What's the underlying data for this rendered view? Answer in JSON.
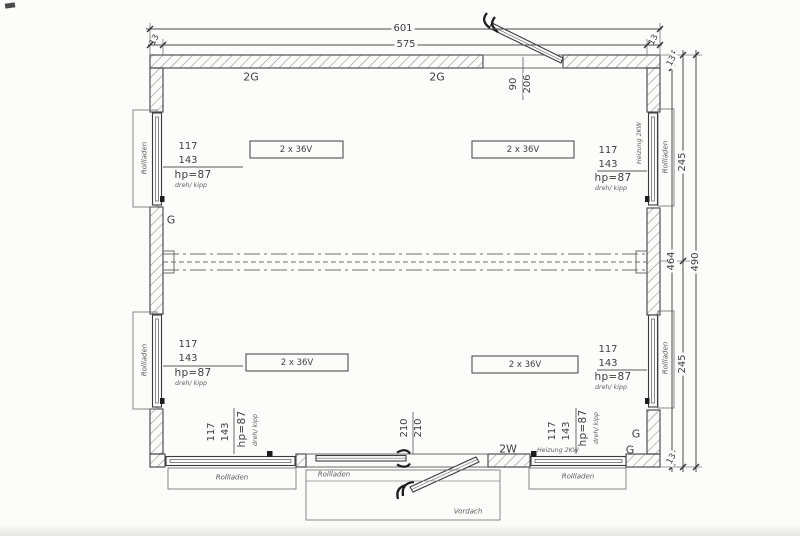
{
  "dimensions": {
    "total_width": "601",
    "inner_width": "575",
    "wall_left": "13",
    "wall_right": "13",
    "wall_top": "13",
    "wall_bottom": "13",
    "inner_height": "464",
    "total_height": "490",
    "half_height_top": "245",
    "half_height_bottom": "245"
  },
  "top_door": {
    "width": "90",
    "height": "206"
  },
  "bottom_door": {
    "width": "210",
    "height": "210",
    "glazing": "2W",
    "shutter": "Rollladen",
    "canopy": "Vordach"
  },
  "glazing_labels": {
    "top_left": "2G",
    "top_center": "2G",
    "left_mid": "G",
    "corner_upper": "G",
    "corner_lower": "G"
  },
  "lights": [
    {
      "label": "2 x 36V"
    },
    {
      "label": "2 x 36V"
    },
    {
      "label": "2 x 36V"
    },
    {
      "label": "2 x 36V"
    }
  ],
  "windows": [
    {
      "id": "left-upper",
      "width": "117",
      "height": "143",
      "parapet": "hp=87",
      "opening_type": "dreh/ kipp",
      "shutter": "Rollladen"
    },
    {
      "id": "left-lower",
      "width": "117",
      "height": "143",
      "parapet": "hp=87",
      "opening_type": "dreh/ kipp",
      "shutter": "Rollladen"
    },
    {
      "id": "right-upper",
      "width": "117",
      "height": "143",
      "parapet": "hp=87",
      "opening_type": "dreh/ kipp",
      "shutter": "Rollladen",
      "heater": "Heizung 2KW"
    },
    {
      "id": "right-lower",
      "width": "117",
      "height": "143",
      "parapet": "hp=87",
      "opening_type": "dreh/ kipp",
      "shutter": "Rollladen"
    },
    {
      "id": "bottom-left",
      "width": "117",
      "height": "143",
      "parapet": "hp=87",
      "opening_type": "dreh/ kipp",
      "shutter": "Rollladen"
    },
    {
      "id": "bottom-right",
      "width": "117",
      "height": "143",
      "parapet": "hp=87",
      "opening_type": "dreh/ kipp",
      "shutter": "Rollladen",
      "heater": "Heizung 2KW"
    }
  ],
  "colors": {
    "line": "#555555",
    "hatch": "#8a8a8a",
    "text": "#3e3e3e",
    "paper": "#fcfcfa"
  }
}
